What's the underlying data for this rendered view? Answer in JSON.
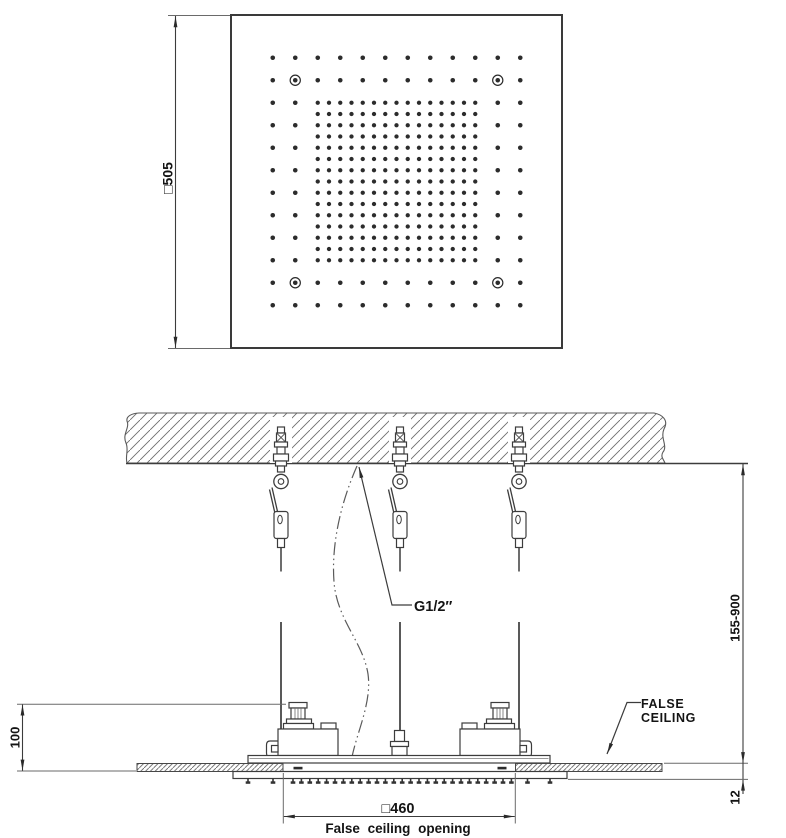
{
  "drawing": {
    "top_view": {
      "size_label": "□505",
      "head_pattern": {
        "sparse_rows": 12,
        "sparse_cols": 12,
        "sparse_spacing_px": 22.5,
        "dense_rows": 15,
        "dense_cols": 15,
        "dense_spacing_px": 11.25,
        "screw_holes": "4 ringed holes near corners, second row/column in from edge"
      }
    },
    "section_view": {
      "connection_label": "G1/2″",
      "height_range_label": "155-900",
      "projection_label": "100",
      "ceiling_offset_label": "12",
      "opening_size_label": "□460",
      "opening_caption": "False ceiling opening",
      "false_ceiling_label_line1": "FALSE",
      "false_ceiling_label_line2": "CEILING",
      "hanger_count": 3
    },
    "colors": {
      "line": "#3c3c3c",
      "thin_line": "#6a6a6a",
      "hatch": "#6e6e6e",
      "text": "#141414",
      "background": "#ffffff"
    }
  }
}
